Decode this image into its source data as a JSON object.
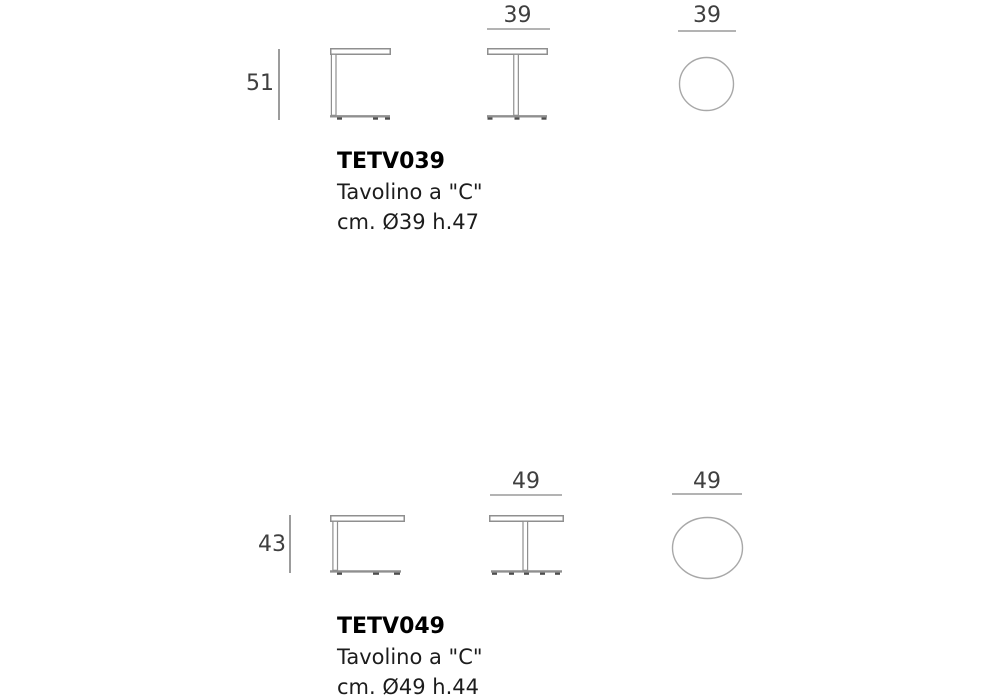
{
  "document_type": "furniture dimension spec sheet",
  "colors": {
    "drawing_line": "#8f8f8f",
    "dimension_line": "#b3b3b3",
    "circle_line": "#a8a8a8",
    "feet": "#4d4d4d",
    "number_text": "#3f3f3f",
    "code_text": "#000000",
    "body_text": "#1c1c1c",
    "page_bg": "#ffffff"
  },
  "products": [
    {
      "code": "TETV039",
      "name": "Tavolino a \"C\"",
      "size": "cm. Ø39 h.47",
      "height_cm": "51",
      "diameter_front_cm": "39",
      "diameter_top_cm": "39"
    },
    {
      "code": "TETV049",
      "name": "Tavolino a \"C\"",
      "size": "cm. Ø49 h.44",
      "height_cm": "43",
      "diameter_front_cm": "49",
      "diameter_top_cm": "49"
    }
  ]
}
